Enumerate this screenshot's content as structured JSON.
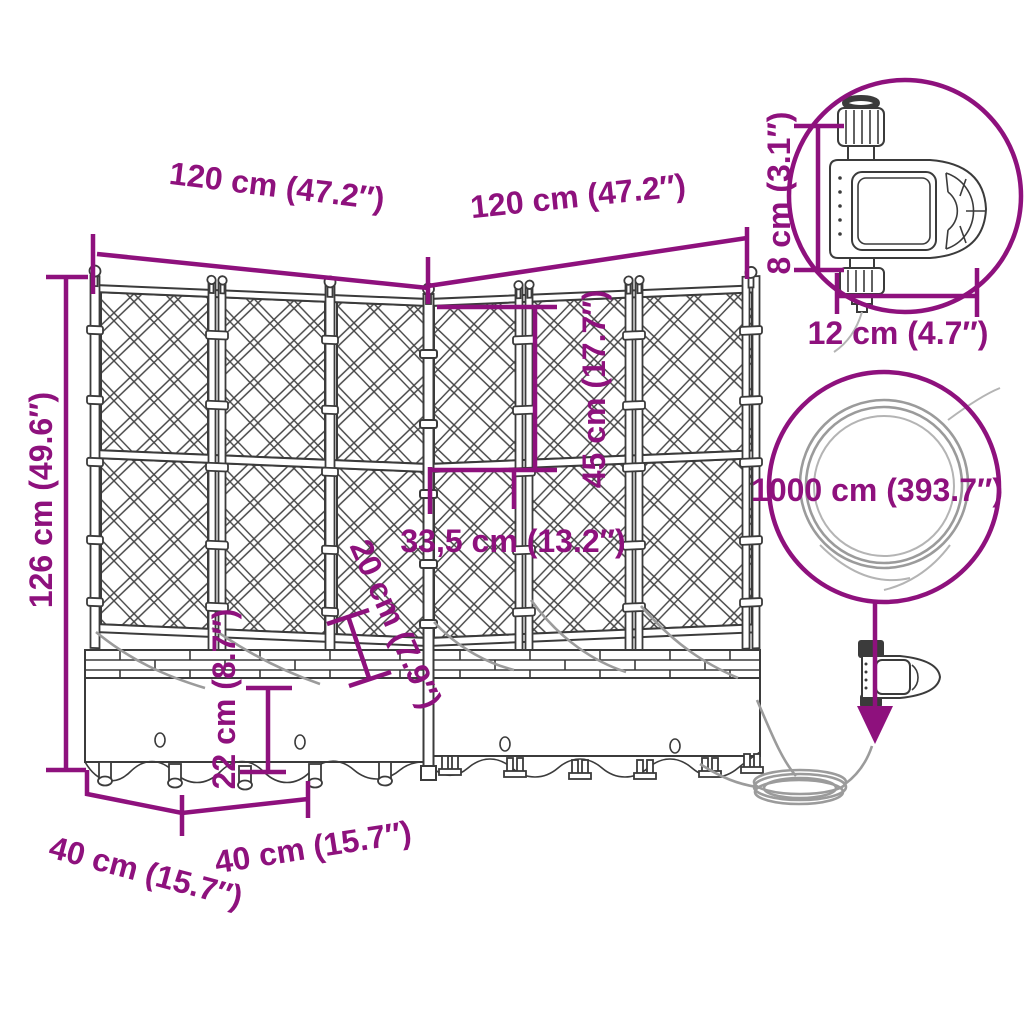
{
  "colors": {
    "accent": "#8E117D",
    "outline": "#3B3B3B",
    "hose": "#9B9B9B"
  },
  "dimensions": {
    "width_left": "120 cm (47.2″)",
    "width_right": "120 cm (47.2″)",
    "height_total": "126 cm (49.6″)",
    "trellis_section_height": "45 cm (17.7″)",
    "panel_width": "33,5 cm (13.2″)",
    "inner_depth": "20 cm (7.9″)",
    "planter_height": "22 cm (8.7″)",
    "depth_left": "40 cm (15.7″)",
    "depth_right": "40 cm (15.7″)",
    "timer_height": "8 cm (3.1″)",
    "timer_width": "12 cm (4.7″)",
    "hose_length": "1000 cm (393.7″)"
  }
}
